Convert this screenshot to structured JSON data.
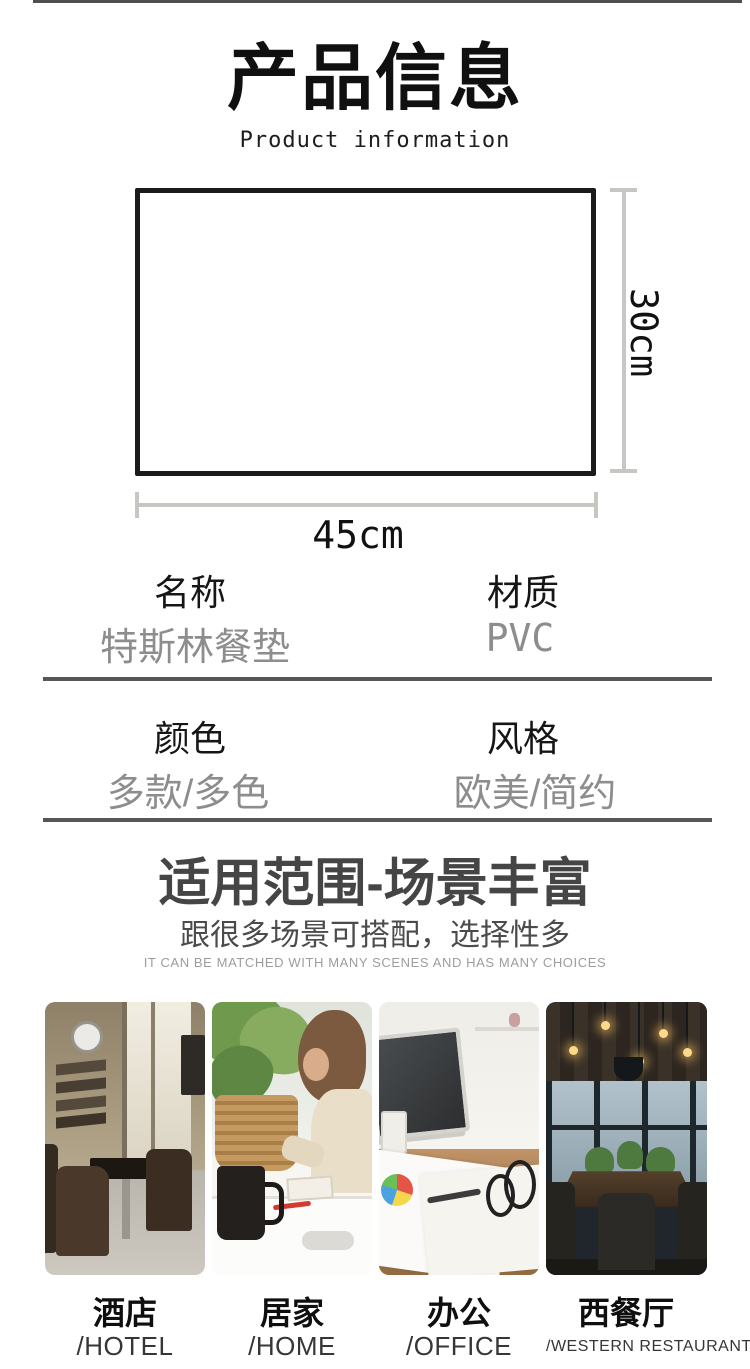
{
  "header": {
    "title": "产品信息",
    "subtitle_en": "Product information"
  },
  "diagram": {
    "width_label": "45cm",
    "height_label": "30cm"
  },
  "specs": {
    "rows": [
      {
        "cells": [
          {
            "label": "名称",
            "value": "特斯林餐垫"
          },
          {
            "label": "材质",
            "value": "PVC"
          }
        ]
      },
      {
        "cells": [
          {
            "label": "颜色",
            "value": "多款/多色"
          },
          {
            "label": "风格",
            "value": "欧美/简约"
          }
        ]
      }
    ]
  },
  "scenes": {
    "title": "适用范围-场景丰富",
    "subtitle": "跟很多场景可搭配，选择性多",
    "subtitle_en": "IT CAN BE MATCHED WITH MANY SCENES AND HAS MANY CHOICES",
    "items": [
      {
        "label": "酒店",
        "label_en": "/HOTEL",
        "photo": "hotel lounge interior"
      },
      {
        "label": "居家",
        "label_en": "/HOME",
        "photo": "child at home table"
      },
      {
        "label": "办公",
        "label_en": "/OFFICE",
        "photo": "office desk with laptop"
      },
      {
        "label": "西餐厅",
        "label_en": "/WESTERN RESTAURANT",
        "photo": "western restaurant interior"
      }
    ]
  },
  "colors": {
    "value_gray": "#8d8d8d",
    "divider_gray": "#565656",
    "dimension_line_gray": "#c7c6c2",
    "section_title_gray": "#454545"
  }
}
